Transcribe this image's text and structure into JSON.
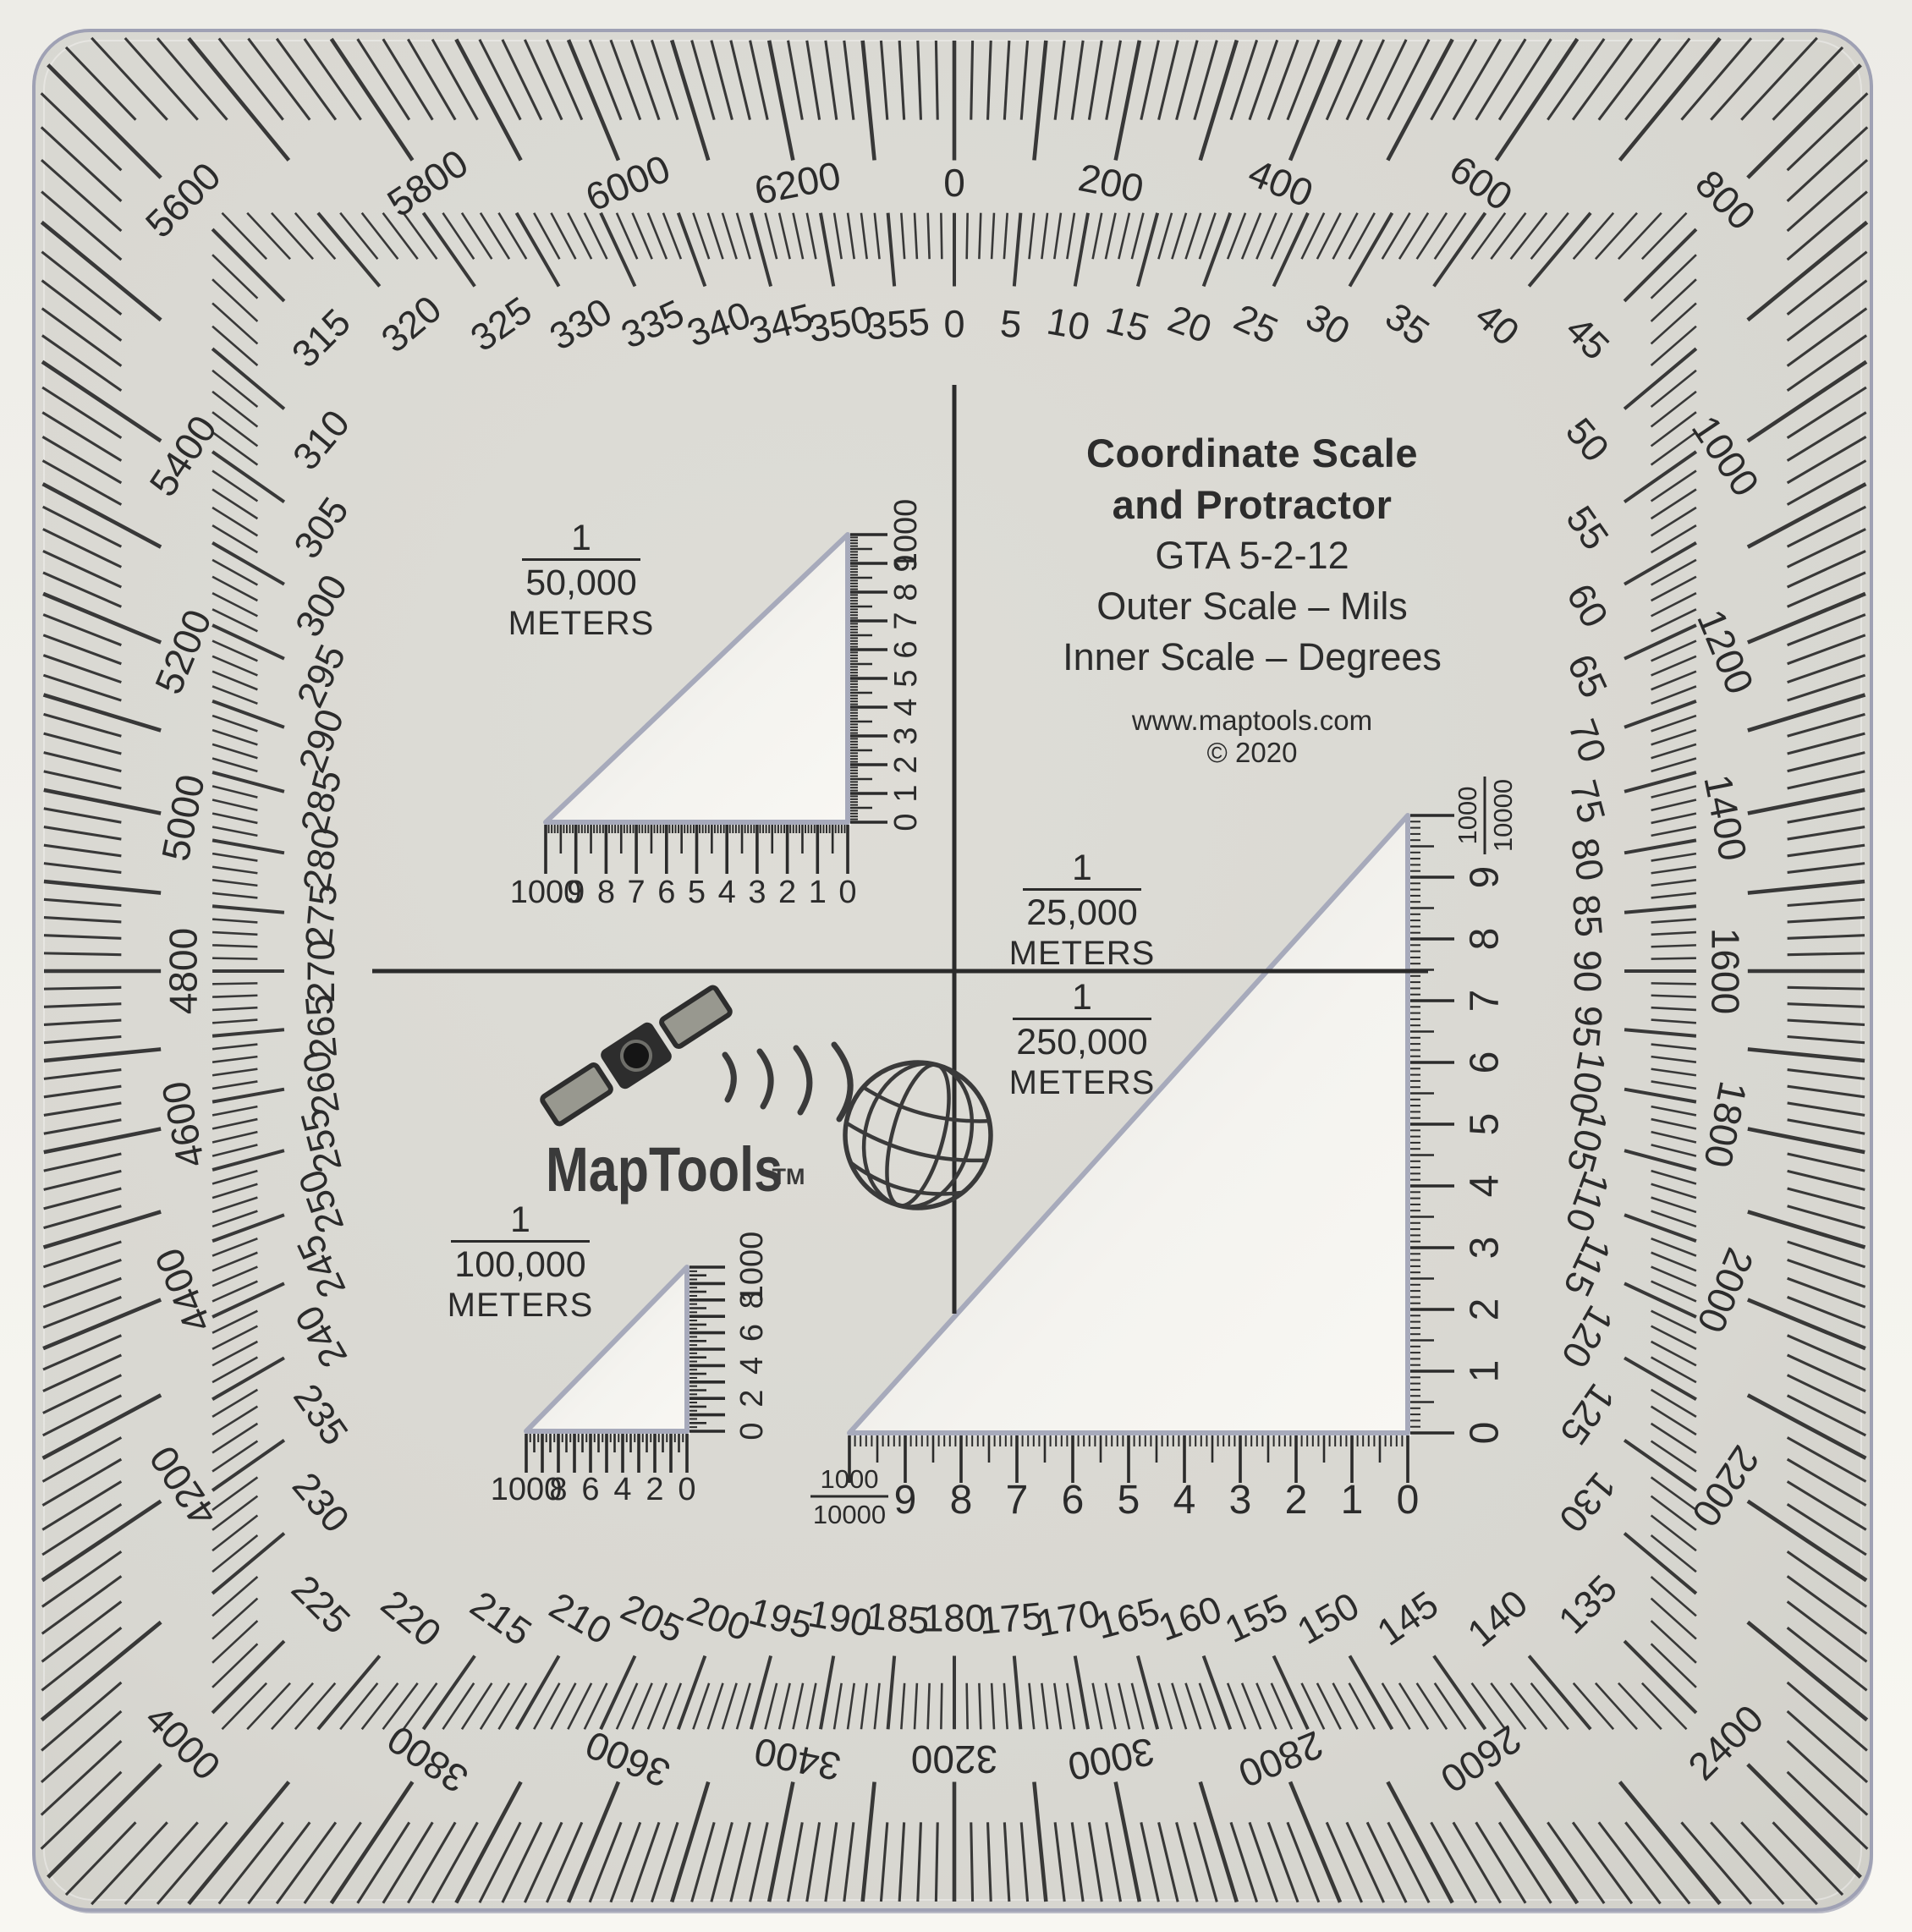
{
  "device": {
    "title_line1": "Coordinate Scale",
    "title_line2": "and Protractor",
    "model": "GTA 5-2-12",
    "outer_scale_note": "Outer Scale – Mils",
    "inner_scale_note": "Inner Scale – Degrees",
    "website": "www.maptools.com",
    "copyright": "© 2020"
  },
  "logo": {
    "brand": "MapTools",
    "trademark": "TM",
    "icons": [
      "satellite-icon",
      "signal-waves-icon",
      "globe-icon"
    ]
  },
  "colors": {
    "paper": "#f3f1eb",
    "body": "#d8d7d1",
    "body_light": "#deddd7",
    "cutout": "#f4f3ef",
    "cutout_dark": "#e3e2dd",
    "edge": "#9fa1b4",
    "ink": "#2b2b2b",
    "logo_ink": "#3a3a3a"
  },
  "protractor": {
    "outer_scale": {
      "unit": "mils",
      "full_circle": 6400,
      "tick_minor_step": 20,
      "tick_major_step": 100,
      "label_step": 200,
      "labels": [
        0,
        200,
        400,
        600,
        800,
        1000,
        1200,
        1400,
        1600,
        1800,
        2000,
        2200,
        2400,
        2600,
        2800,
        3000,
        3200,
        3400,
        3600,
        3800,
        4000,
        4200,
        4400,
        4600,
        4800,
        5000,
        5200,
        5400,
        5600,
        5800,
        6000,
        6200
      ]
    },
    "inner_scale": {
      "unit": "degrees",
      "full_circle": 360,
      "tick_minor_step": 1,
      "tick_major_step": 5,
      "label_step": 5,
      "labels": [
        0,
        5,
        10,
        15,
        20,
        25,
        30,
        35,
        40,
        45,
        50,
        55,
        60,
        65,
        70,
        75,
        80,
        85,
        90,
        95,
        100,
        105,
        110,
        115,
        120,
        125,
        130,
        135,
        140,
        145,
        150,
        155,
        160,
        165,
        170,
        175,
        180,
        185,
        190,
        195,
        200,
        205,
        210,
        215,
        220,
        225,
        230,
        235,
        240,
        245,
        250,
        255,
        260,
        265,
        270,
        275,
        280,
        285,
        290,
        295,
        300,
        305,
        310,
        315,
        320,
        325,
        330,
        335,
        340,
        345,
        350,
        355
      ]
    }
  },
  "scale_labels": {
    "s50k": {
      "numerator": "1",
      "denominator": "50,000",
      "unit": "METERS"
    },
    "s25k": {
      "numerator": "1",
      "denominator": "25,000",
      "unit": "METERS"
    },
    "s250k": {
      "numerator": "1",
      "denominator": "250,000",
      "unit": "METERS"
    },
    "s100k": {
      "numerator": "1",
      "denominator": "100,000",
      "unit": "METERS"
    }
  },
  "coordinate_scales": {
    "s50k": {
      "bottom_labels": [
        "1000",
        "9",
        "8",
        "7",
        "6",
        "5",
        "4",
        "3",
        "2",
        "1",
        "0"
      ],
      "side_labels": [
        "0",
        "1",
        "2",
        "3",
        "4",
        "5",
        "6",
        "7",
        "8",
        "9",
        "1000"
      ]
    },
    "s100k": {
      "bottom_labels": [
        "1000",
        "8",
        "6",
        "4",
        "2",
        "0"
      ],
      "side_labels": [
        "0",
        "2",
        "4",
        "6",
        "8",
        "1000"
      ]
    },
    "large": {
      "bottom_digits": [
        "9",
        "8",
        "7",
        "6",
        "5",
        "4",
        "3",
        "2",
        "1",
        "0"
      ],
      "side_digits": [
        "0",
        "1",
        "2",
        "3",
        "4",
        "5",
        "6",
        "7",
        "8",
        "9"
      ],
      "fraction": {
        "numerator": "1000",
        "denominator": "10000"
      }
    }
  }
}
